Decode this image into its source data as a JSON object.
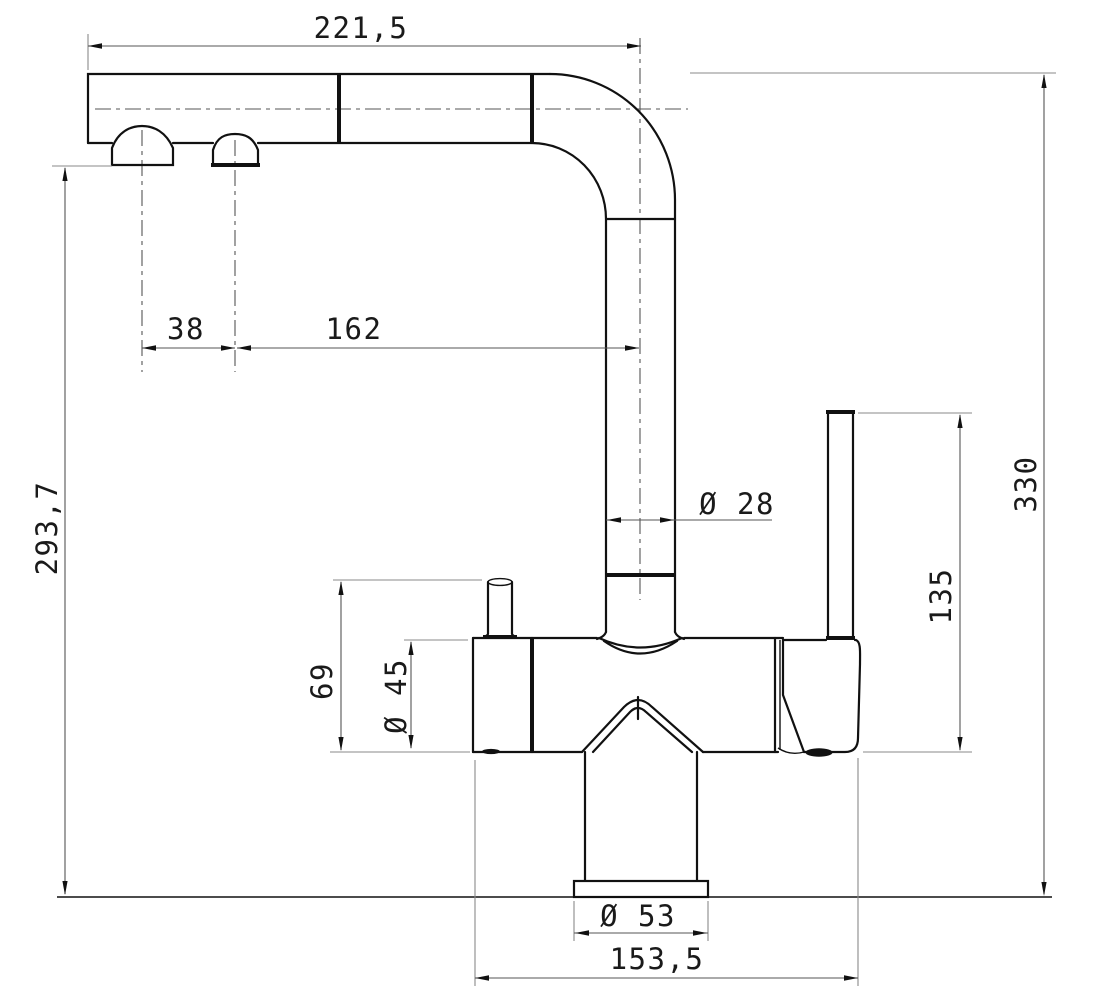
{
  "drawing": {
    "title": "kitchen-faucet-technical-drawing-side-view",
    "units": "mm",
    "background_color": "#ffffff",
    "line_color": "#111111",
    "dimensions": {
      "spout_reach": {
        "label": "221,5",
        "value": 221.5,
        "orientation": "horizontal",
        "measures": "left end of spout to riser centerline"
      },
      "aerator_spacing": {
        "label": "38",
        "value": 38,
        "orientation": "horizontal",
        "measures": "distance between the two outlet centerlines"
      },
      "aerator_to_riser": {
        "label": "162",
        "value": 162,
        "orientation": "horizontal",
        "measures": "second outlet centerline to riser centerline"
      },
      "deck_to_spout_outlet": {
        "label": "293,7",
        "value": 293.7,
        "orientation": "vertical",
        "measures": "mounting deck to spout outlet face"
      },
      "overall_height": {
        "label": "330",
        "value": 330,
        "orientation": "vertical",
        "measures": "mounting deck to top of spout"
      },
      "lever_height": {
        "label": "135",
        "value": 135,
        "orientation": "vertical",
        "measures": "body bottom to top of handle lever"
      },
      "riser_diameter": {
        "label": "Ø 28",
        "value": 28,
        "orientation": "horizontal",
        "measures": "riser tube diameter"
      },
      "knob_height": {
        "label": "69",
        "value": 69,
        "orientation": "vertical",
        "measures": "body bottom to top of side knob"
      },
      "body_diameter": {
        "label": "Ø 45",
        "value": 45,
        "orientation": "vertical",
        "measures": "valve body diameter"
      },
      "base_diameter": {
        "label": "Ø 53",
        "value": 53,
        "orientation": "horizontal",
        "measures": "base flange diameter"
      },
      "body_length": {
        "label": "153,5",
        "value": 153.5,
        "orientation": "horizontal",
        "measures": "overall valve body length"
      }
    }
  }
}
